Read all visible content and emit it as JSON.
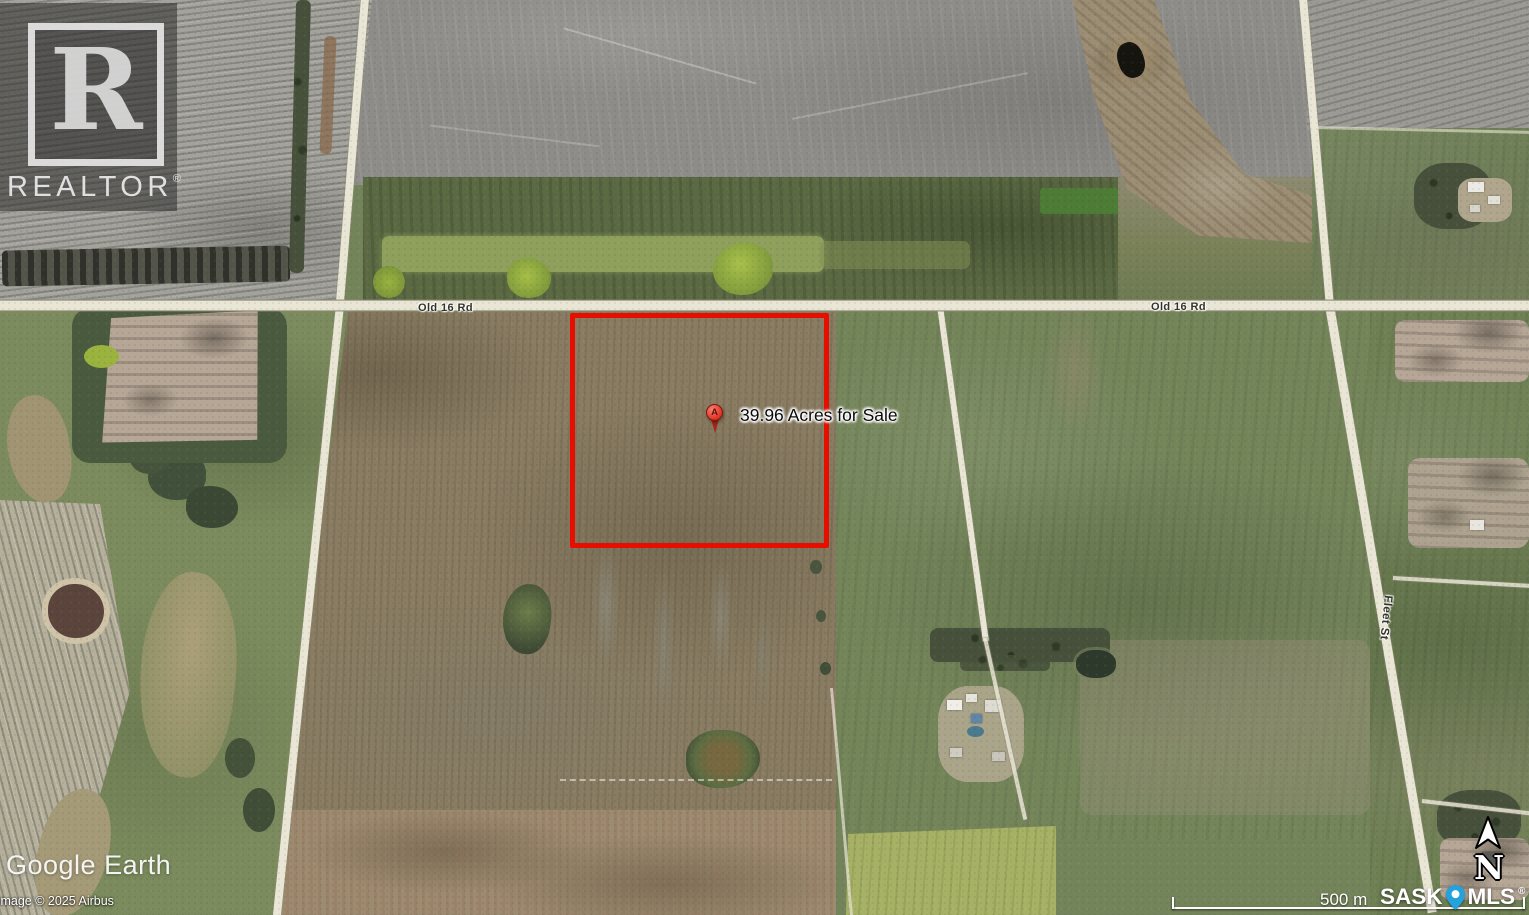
{
  "map": {
    "listing_label": "39.96 Acres for Sale",
    "marker_letter": "A",
    "road_label_left": "Old 16 Rd",
    "road_label_right": "Old 16 Rd",
    "street_label": "Fleet St"
  },
  "branding": {
    "realtor_monogram": "R",
    "realtor_wordmark": "REALTOR",
    "realtor_registered": "®",
    "google_earth": "Google Earth",
    "attribution": "Image © 2025 Airbus",
    "sask": "SASK",
    "mls": "MLS",
    "mls_registered": "®"
  },
  "scale_bar": {
    "label": "500 m"
  },
  "compass": {
    "north_label": "N"
  },
  "colors": {
    "parcel_outline": "#e70e00",
    "marker_red": "#e03a2b",
    "mls_pin_blue": "#23a2de",
    "road": "#eae6d6"
  }
}
